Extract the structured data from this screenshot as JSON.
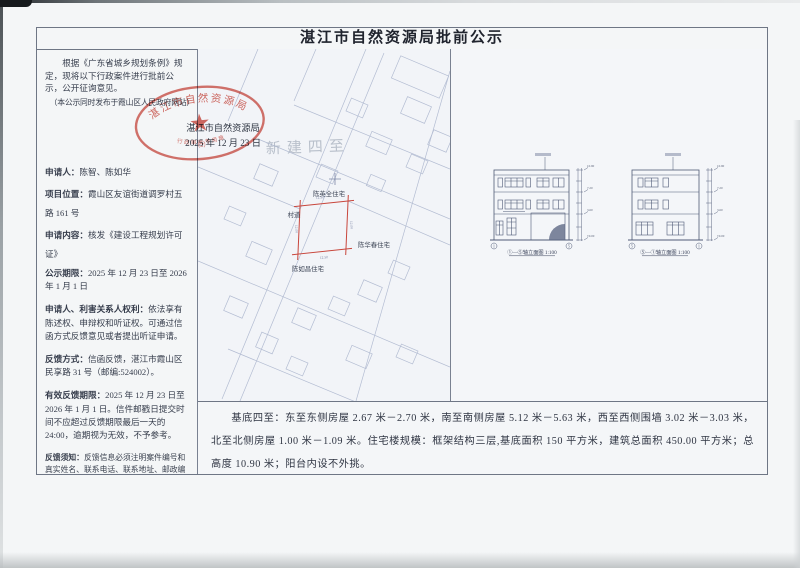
{
  "doc": {
    "title": "湛江市自然资源局批前公示"
  },
  "left_column": {
    "intro": "根据《广东省城乡规划条例》规定，现将以下行政案件进行批前公示，公开征询意见。",
    "publish_note": "（本公示同时发布于霞山区人民政府网站）",
    "agency": "湛江市自然资源局",
    "date": "2025 年 12 月 23 日",
    "items": [
      {
        "label": "申请人：",
        "text": "陈智、陈如华"
      },
      {
        "label": "项目位置：",
        "text": "霞山区友谊街道调罗村五路 161 号"
      },
      {
        "label": "申请内容：",
        "text": "核发《建设工程规划许可证》"
      },
      {
        "label": "公示期限：",
        "text": "2025 年 12 月 23 日至 2026 年 1 月 1 日"
      },
      {
        "label": "申请人、利害关系人权利：",
        "text": "依法享有陈述权、申辩权和听证权。可通过信函方式反馈意见或者提出听证申请。"
      },
      {
        "label": "反馈方式：",
        "text": "信函反馈，湛江市霞山区民享路 31 号（邮编:524002）。"
      },
      {
        "label": "有效反馈期限：",
        "text": "2025 年 12 月 23 日至 2026 年 1 月 1 日。信件邮戳日提交时间不应超过反馈期限最后一天的 24:00，逾期视为无效，不予参考。"
      }
    ],
    "notice_label": "反馈须知：",
    "notice_text": "反馈信息必须注明案件编号和真实姓名、联系电话、联系地址、邮政编码，如反馈信息不准确或不完整，导致无法核实有关情况的视为无效。"
  },
  "seal": {
    "ring_text": "湛江市自然资源局",
    "sub_text": "行政审批专用章",
    "number": "（2）",
    "color": "#cc4237"
  },
  "site_plan": {
    "watermark": "新建四至",
    "labels": {
      "north": "陈英全住宅",
      "road": "村道",
      "east": "陈华春住宅",
      "south": "陈如昌住宅"
    },
    "dims": [
      "12.50",
      "12.00",
      "12.50",
      "12.00"
    ],
    "plot_color": "#c8463c"
  },
  "elevations": [
    {
      "caption": "①—⑤轴立面图 1:100",
      "levels": [
        "10.90",
        "7.20",
        "3.60",
        "±0.00"
      ],
      "axis_start": "1",
      "axis_end": "5"
    },
    {
      "caption": "⑤—①轴立面图 1:100",
      "levels": [
        "10.90",
        "7.20",
        "3.60",
        "±0.00"
      ],
      "axis_start": "5",
      "axis_end": "1"
    }
  ],
  "summary": {
    "text": "基底四至：东至东侧房屋 2.67 米－2.70 米，南至南侧房屋 5.12 米－5.63 米，西至西侧围墙 3.02 米－3.03 米，北至北侧房屋 1.00 米－1.09 米。住宅楼规模：框架结构三层,基底面积 150 平方米，建筑总面积 450.00 平方米；总高度 10.90 米；阳台内设不外挑。"
  }
}
